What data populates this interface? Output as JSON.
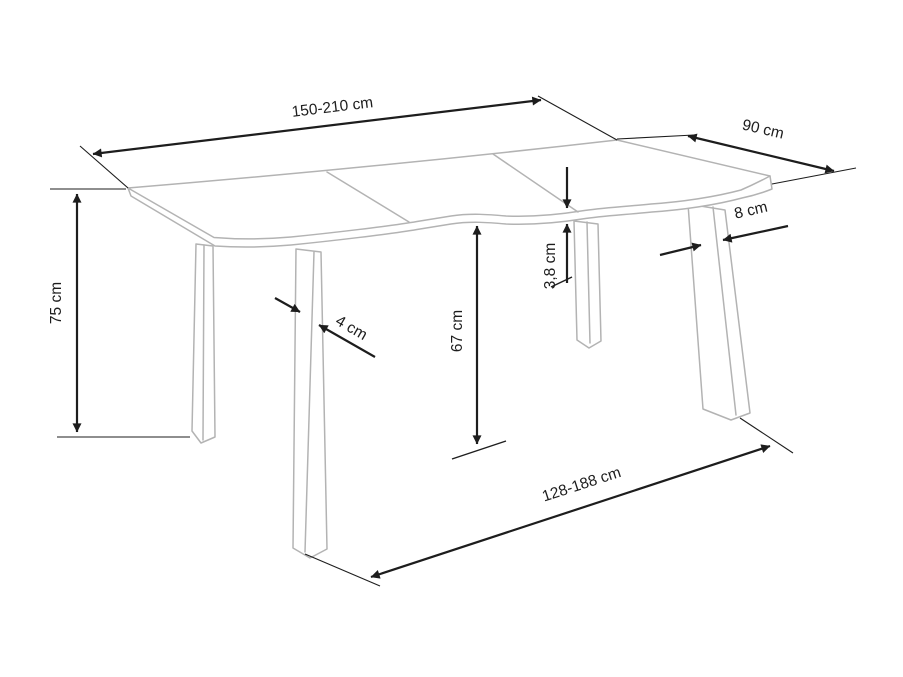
{
  "page": {
    "background": "#ffffff",
    "kind": "furniture dimension drawing",
    "subject": "extendable wave-edge table with four splayed legs"
  },
  "diagram": {
    "colors": {
      "outline": "#b3b3b3",
      "dimension": "#1d1d1d",
      "background": "#ffffff"
    },
    "labels": {
      "length_top": "150-210 cm",
      "depth": "90 cm",
      "height": "75 cm",
      "underside_height": "67 cm",
      "top_thickness": "3,8 cm",
      "front_leg_width": "8 cm",
      "side_leg_width": "4 cm",
      "leg_span_bottom": "128-188 cm"
    }
  }
}
